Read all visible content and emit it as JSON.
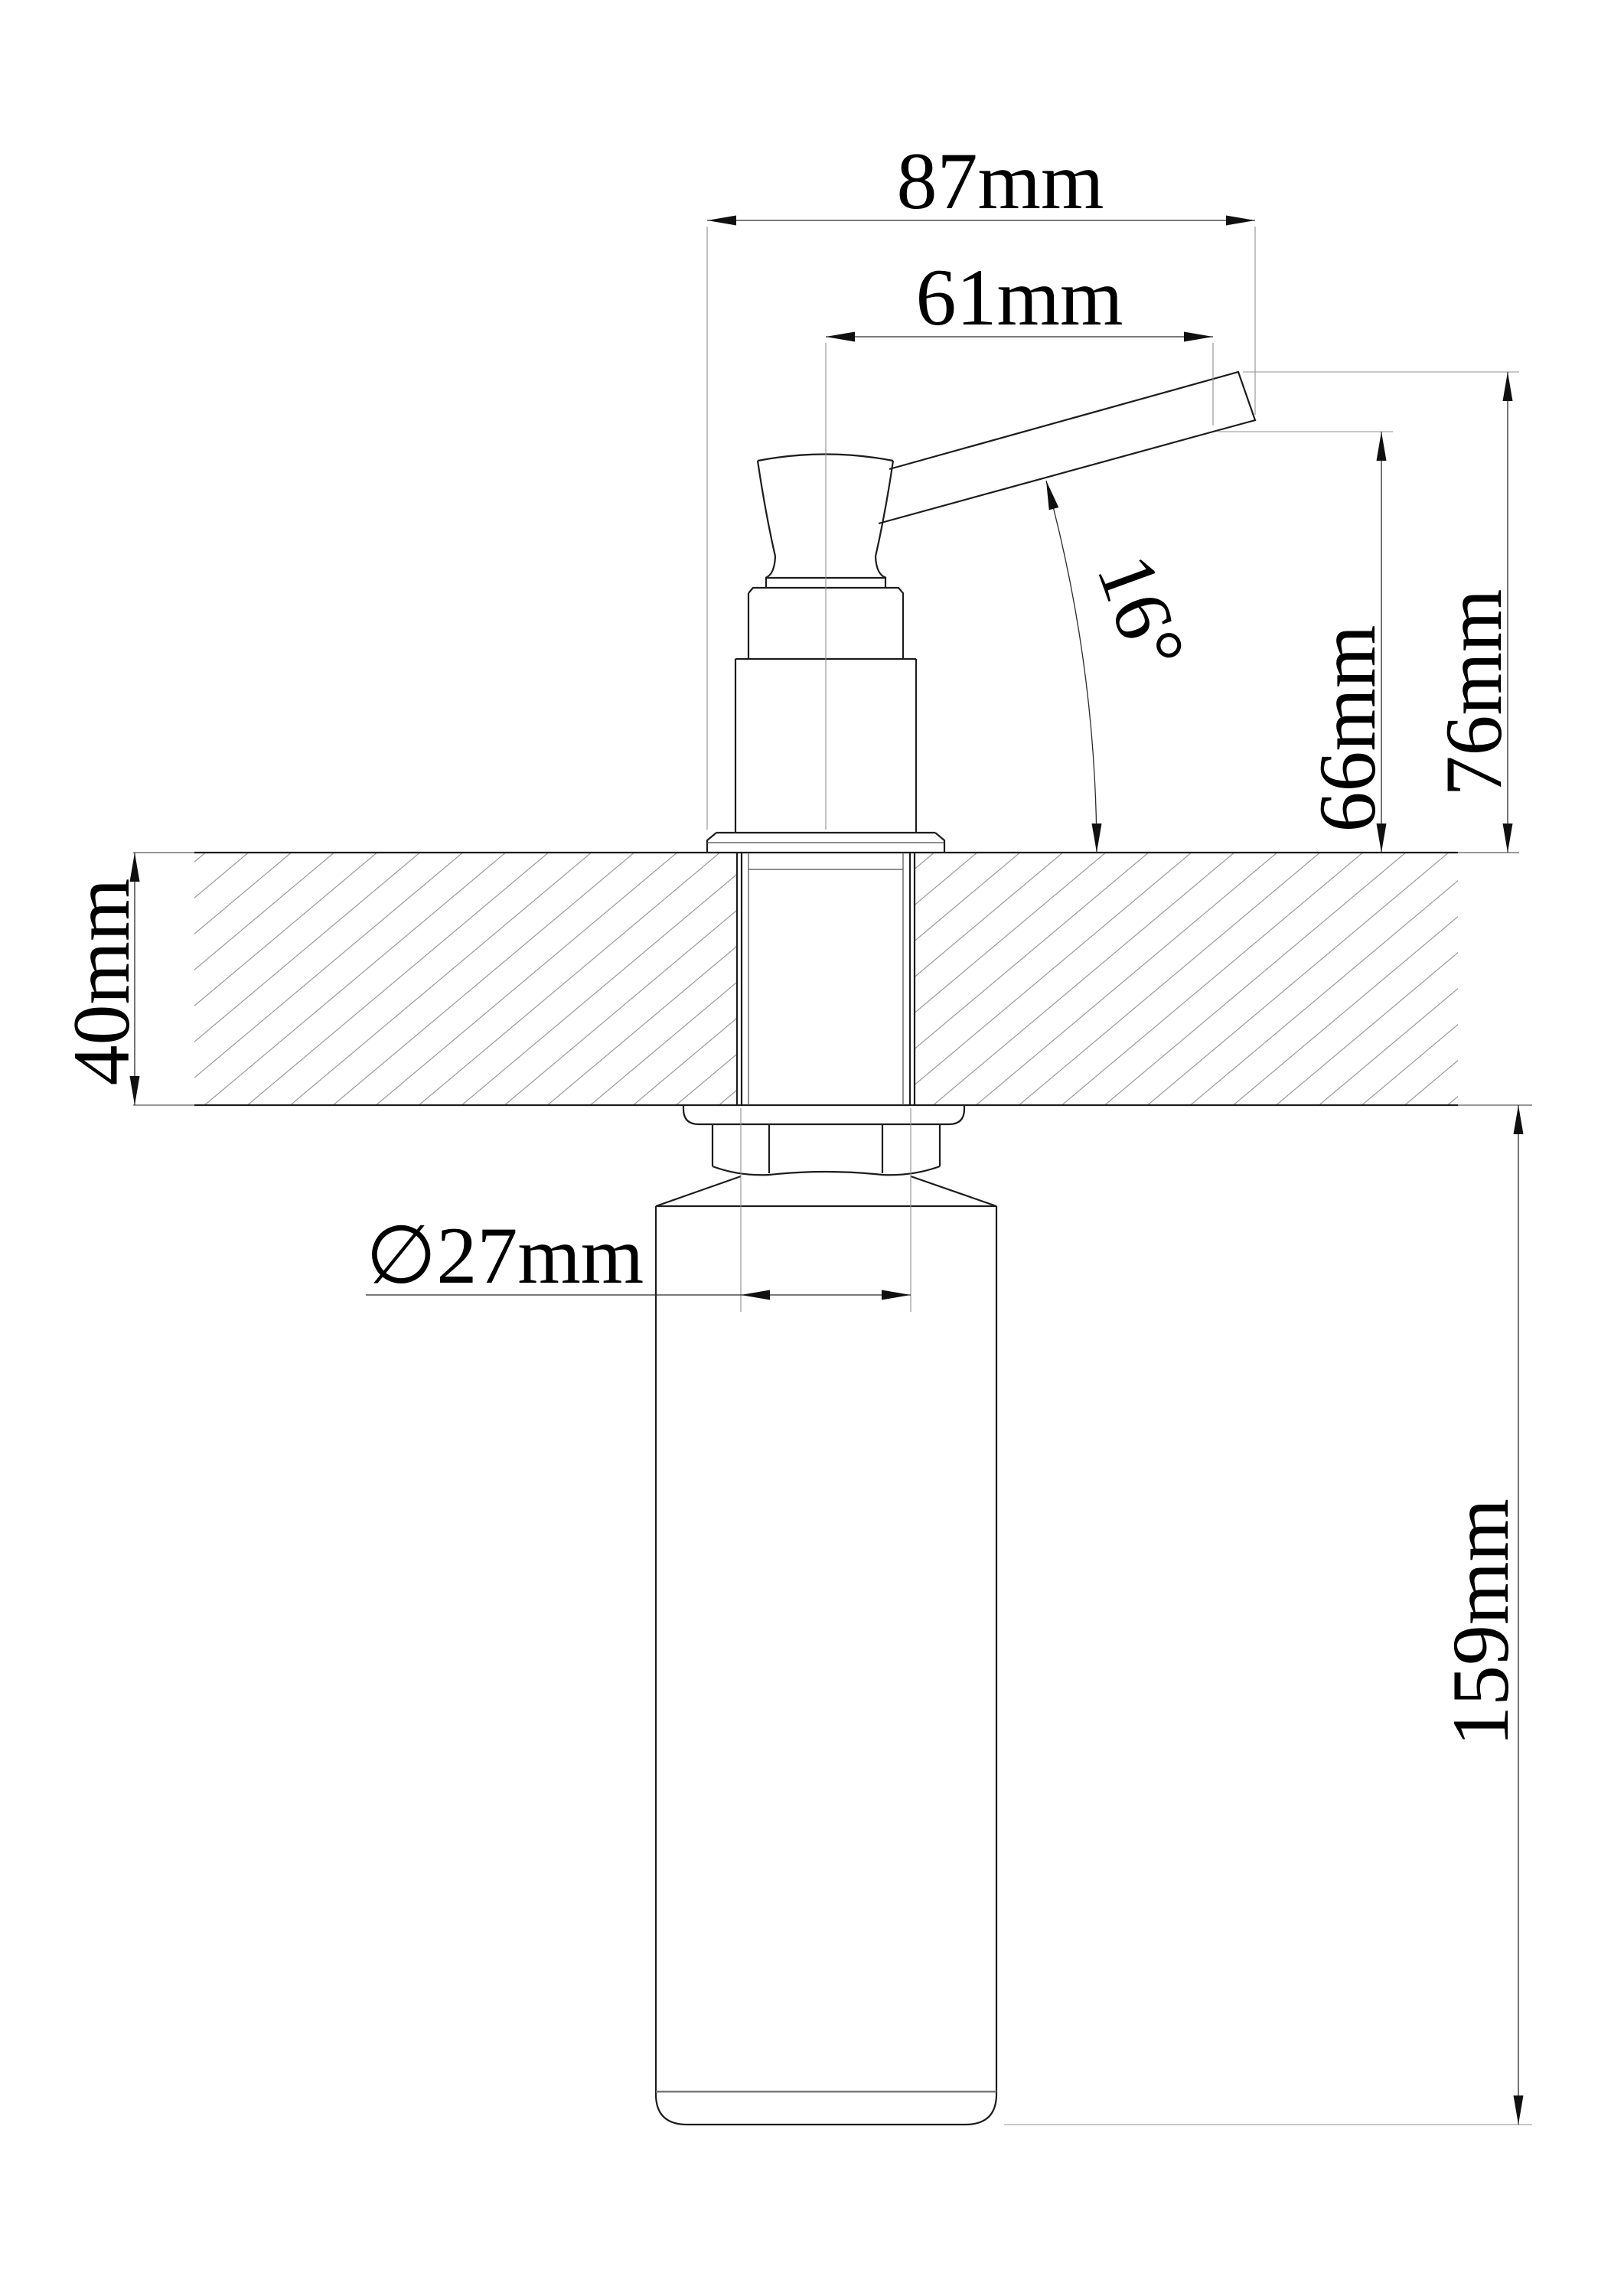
{
  "drawing": {
    "units": "mm",
    "background": "#ffffff",
    "ink_color": "#1c1c1c",
    "hatch_color": "#8f8f8f",
    "dimensions": {
      "spout_reach_overall": "87mm",
      "spout_reach_from_center": "61mm",
      "spout_angle": "16°",
      "height_to_spout_underside": "66mm",
      "height_to_spout_tip": "76mm",
      "deck_thickness": "40mm",
      "neck_diameter": "∅27mm",
      "bottle_length": "159mm"
    }
  }
}
